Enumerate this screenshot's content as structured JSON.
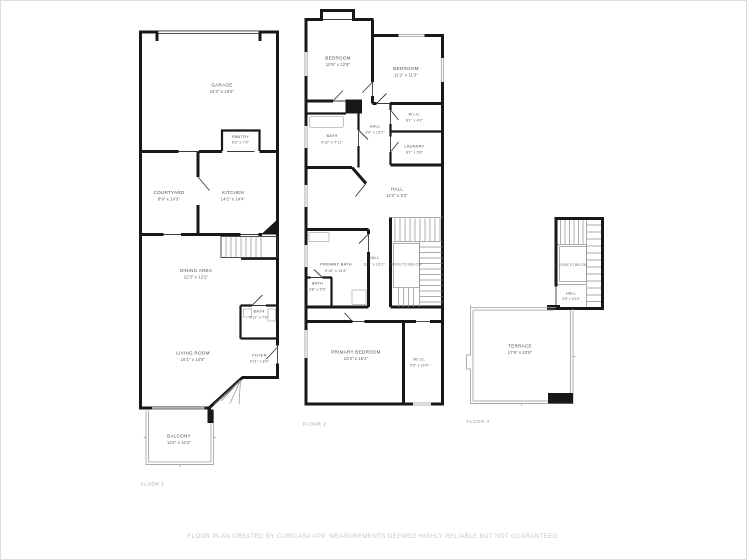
{
  "footer": {
    "text": "FLOOR PLAN CREATED BY CUBICASA APP. MEASUREMENTS DEEMED HIGHLY RELIABLE BUT NOT GUARANTEED."
  },
  "colors": {
    "wall": "#181818",
    "open_outline": "#a8a8a8",
    "room_label": "#4d4d4d",
    "floor_label": "#9b9b9b",
    "footer": "#c7c7c7"
  },
  "floor1": {
    "label": "FLOOR 1",
    "rooms": {
      "garage": {
        "name": "GARAGE",
        "dims": "22'3\" x 19'5\""
      },
      "pantry": {
        "name": "PANTRY",
        "dims": "6'0\" x 7'0\""
      },
      "courtyard": {
        "name": "COURTYARD",
        "dims": "8'9\" x 14'3\""
      },
      "kitchen": {
        "name": "KITCHEN",
        "dims": "14'2\" x 14'4\""
      },
      "dining": {
        "name": "DINING AREA",
        "dims": "22'3\" x 12'2\""
      },
      "bath": {
        "name": "BATH",
        "dims": "5'11\" x 7'6\""
      },
      "living": {
        "name": "LIVING ROOM",
        "dims": "16'1\" x 14'8\""
      },
      "foyer": {
        "name": "FOYER",
        "dims": "5'11\" x 8'9\""
      },
      "balcony": {
        "name": "BALCONY",
        "dims": "11'6\" x 10'4\""
      }
    }
  },
  "floor2": {
    "label": "FLOOR 2",
    "rooms": {
      "bedroom1": {
        "name": "BEDROOM",
        "dims": "10'9\" x 12'9\""
      },
      "bedroom2": {
        "name": "BEDROOM",
        "dims": "11'2\" x 11'3\""
      },
      "bath": {
        "name": "BATH",
        "dims": "9'10\" x 7'11\""
      },
      "hall_upper": {
        "name": "HALL",
        "dims": "3'6\" x 13'2\""
      },
      "wic": {
        "name": "W.I.C.",
        "dims": "8'1\" x 4'2\""
      },
      "laundry": {
        "name": "LAUNDRY",
        "dims": "8'1\" x 5'6\""
      },
      "hall_main": {
        "name": "HALL",
        "dims": "14'2\" x 9'3\""
      },
      "primary_bath": {
        "name": "PRIMARY BATH",
        "dims": "9'10\" x 13'4\""
      },
      "hall_lower": {
        "name": "HALL",
        "dims": "11'1\" x 13'1\""
      },
      "open_below": {
        "name": "OPEN TO BELOW"
      },
      "bath_small": {
        "name": "BATH",
        "dims": "3'8\" x 5'5\""
      },
      "primary_bedroom": {
        "name": "PRIMARY BEDROOM",
        "dims": "15'3\" x 16'4\""
      },
      "wic2": {
        "name": "W.I.C.",
        "dims": "5'9\" x 16'4\""
      }
    }
  },
  "floor3": {
    "label": "FLOOR 3",
    "rooms": {
      "open_below": {
        "name": "OPEN TO BELOW"
      },
      "hall": {
        "name": "HALL",
        "dims": "3'8\" x 3'10\""
      },
      "terrace": {
        "name": "TERRACE",
        "dims": "17'9\" x 20'8\""
      }
    }
  }
}
